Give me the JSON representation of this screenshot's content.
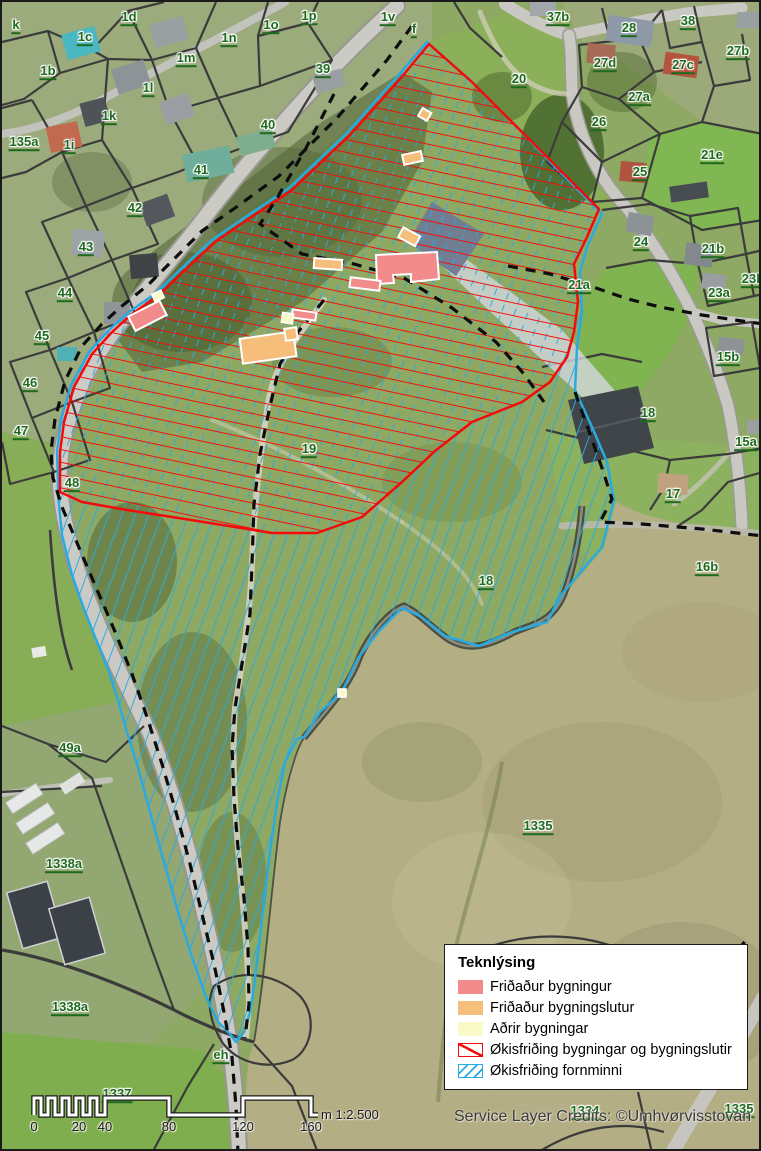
{
  "colors": {
    "label_green": "#1d6a1d",
    "red_zone": "#f30b0b",
    "cyan_zone": "#29abe2",
    "protected_building": "#f28c8c",
    "protected_part": "#f5be7a",
    "other_building": "#fafac8",
    "dashed_line": "#0d0d0d",
    "parcel_line": "#3b3b3b"
  },
  "legend": {
    "title": "Teknlýsing",
    "items": [
      {
        "label": "Friðaður bygningur",
        "swatch": "fill",
        "color": "#f28c8c"
      },
      {
        "label": "Friðaður bygningslutur",
        "swatch": "fill",
        "color": "#f5be7a"
      },
      {
        "label": "Aðrir bygningar",
        "swatch": "fill",
        "color": "#fafac8"
      },
      {
        "label": "Økisfriðing bygningar og bygningslutir",
        "swatch": "hatch-single",
        "color": "#f30b0b"
      },
      {
        "label": "Økisfriðing fornminni",
        "swatch": "hatch-double",
        "color": "#29abe2"
      }
    ]
  },
  "scalebar": {
    "ticks": [
      {
        "label": "0",
        "x": 32
      },
      {
        "label": "20",
        "x": 77
      },
      {
        "label": "40",
        "x": 103
      },
      {
        "label": "80",
        "x": 167
      },
      {
        "label": "120",
        "x": 241
      },
      {
        "label": "160",
        "x": 309
      }
    ],
    "note": "m 1:2.500"
  },
  "credits": "Service Layer Credits: ©Umhvørvisstovan",
  "map_labels": [
    {
      "text": "k",
      "x": 14,
      "y": 25
    },
    {
      "text": "1c",
      "x": 83,
      "y": 37
    },
    {
      "text": "1d",
      "x": 127,
      "y": 17
    },
    {
      "text": "1n",
      "x": 227,
      "y": 38
    },
    {
      "text": "1o",
      "x": 269,
      "y": 25
    },
    {
      "text": "1p",
      "x": 307,
      "y": 16
    },
    {
      "text": "1v",
      "x": 386,
      "y": 17
    },
    {
      "text": "f",
      "x": 412,
      "y": 29
    },
    {
      "text": "37b",
      "x": 556,
      "y": 17
    },
    {
      "text": "28",
      "x": 627,
      "y": 28
    },
    {
      "text": "38",
      "x": 686,
      "y": 21
    },
    {
      "text": "27d",
      "x": 603,
      "y": 63
    },
    {
      "text": "27c",
      "x": 681,
      "y": 65
    },
    {
      "text": "27b",
      "x": 736,
      "y": 51
    },
    {
      "text": "1b",
      "x": 46,
      "y": 71
    },
    {
      "text": "1m",
      "x": 184,
      "y": 58
    },
    {
      "text": "39",
      "x": 321,
      "y": 69
    },
    {
      "text": "20",
      "x": 517,
      "y": 79
    },
    {
      "text": "27a",
      "x": 637,
      "y": 97
    },
    {
      "text": "1l",
      "x": 146,
      "y": 88
    },
    {
      "text": "26",
      "x": 597,
      "y": 122
    },
    {
      "text": "1k",
      "x": 107,
      "y": 116
    },
    {
      "text": "40",
      "x": 266,
      "y": 125
    },
    {
      "text": "21e",
      "x": 710,
      "y": 155
    },
    {
      "text": "135a",
      "x": 22,
      "y": 142
    },
    {
      "text": "1i",
      "x": 67,
      "y": 145
    },
    {
      "text": "25",
      "x": 638,
      "y": 172
    },
    {
      "text": "41",
      "x": 199,
      "y": 170
    },
    {
      "text": "42",
      "x": 133,
      "y": 208
    },
    {
      "text": "24",
      "x": 639,
      "y": 242
    },
    {
      "text": "21b",
      "x": 711,
      "y": 249
    },
    {
      "text": "23b",
      "x": 751,
      "y": 279
    },
    {
      "text": "23a",
      "x": 717,
      "y": 293
    },
    {
      "text": "43",
      "x": 84,
      "y": 247
    },
    {
      "text": "21a",
      "x": 577,
      "y": 285
    },
    {
      "text": "44",
      "x": 63,
      "y": 293
    },
    {
      "text": "15b",
      "x": 726,
      "y": 357
    },
    {
      "text": "45",
      "x": 40,
      "y": 336
    },
    {
      "text": "46",
      "x": 28,
      "y": 383
    },
    {
      "text": "18",
      "x": 646,
      "y": 413
    },
    {
      "text": "15a",
      "x": 744,
      "y": 442
    },
    {
      "text": "47",
      "x": 19,
      "y": 431
    },
    {
      "text": "17",
      "x": 671,
      "y": 494
    },
    {
      "text": "48",
      "x": 70,
      "y": 483
    },
    {
      "text": "16b",
      "x": 705,
      "y": 567
    },
    {
      "text": "19",
      "x": 307,
      "y": 449
    },
    {
      "text": "18",
      "x": 484,
      "y": 581
    },
    {
      "text": "49a",
      "x": 68,
      "y": 748
    },
    {
      "text": "1338a",
      "x": 62,
      "y": 864
    },
    {
      "text": "1335",
      "x": 536,
      "y": 826
    },
    {
      "text": "1338a",
      "x": 68,
      "y": 1007
    },
    {
      "text": "eh",
      "x": 219,
      "y": 1055
    },
    {
      "text": "1337",
      "x": 115,
      "y": 1094
    },
    {
      "text": "1334",
      "x": 583,
      "y": 1111
    },
    {
      "text": "1335",
      "x": 737,
      "y": 1109
    }
  ]
}
